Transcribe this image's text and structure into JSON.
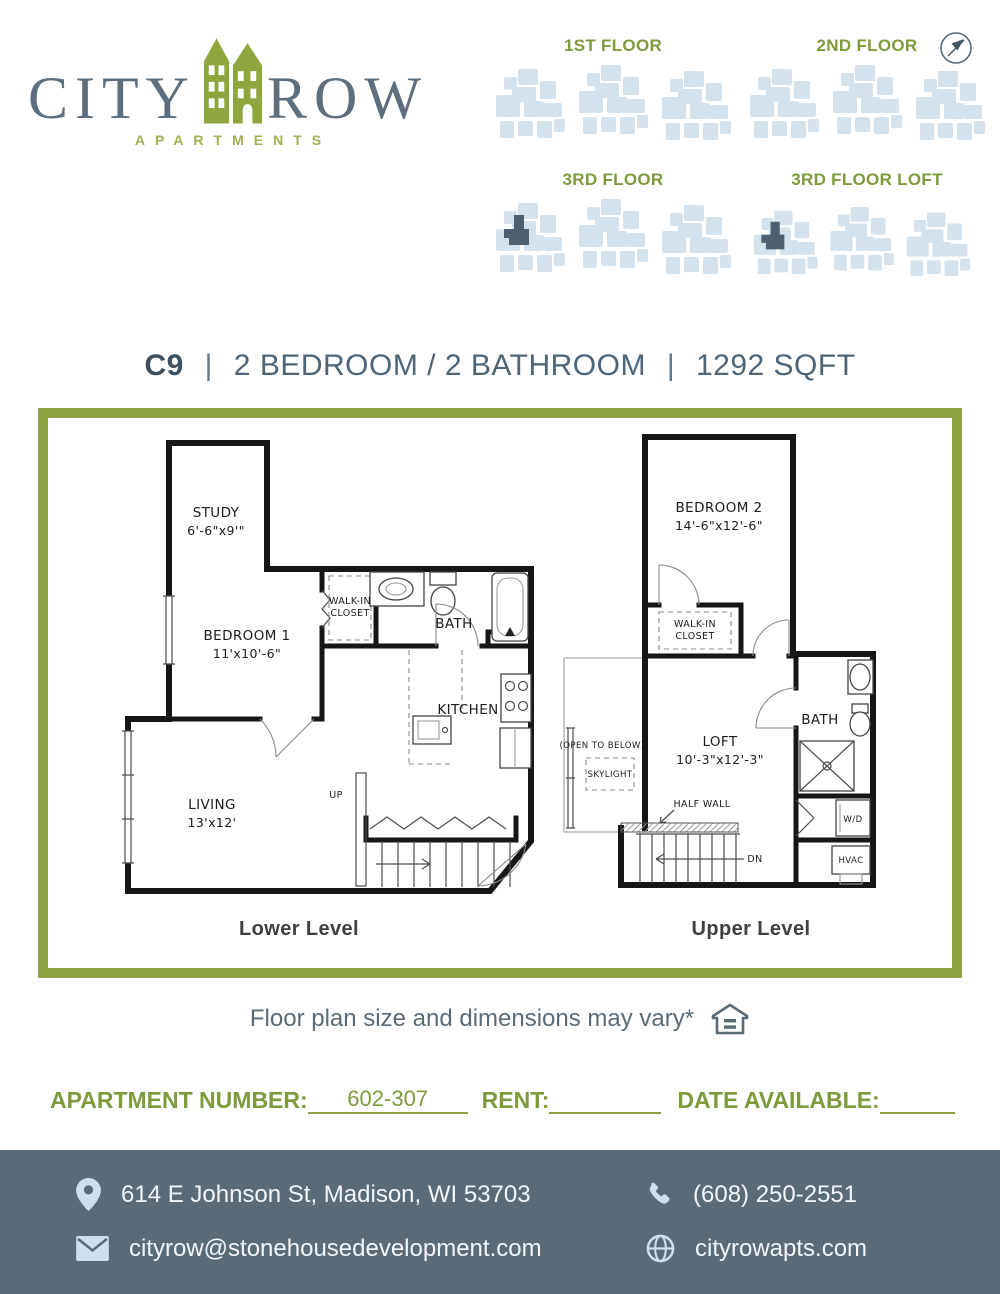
{
  "logo": {
    "city": "CITY",
    "row": "ROW",
    "subtitle": "APARTMENTS"
  },
  "floor_maps": {
    "first": {
      "label": "1ST FLOOR"
    },
    "second": {
      "label": "2ND FLOOR"
    },
    "third": {
      "label": "3RD FLOOR"
    },
    "third_loft": {
      "label": "3RD FLOOR LOFT"
    }
  },
  "title": {
    "unit": "C9",
    "divider": "|",
    "beds_baths": "2 BEDROOM / 2 BATHROOM",
    "sqft": "1292 SQFT"
  },
  "floor_plan": {
    "lower": {
      "caption": "Lower Level",
      "study": "STUDY",
      "study_dims": "6'-6\"x9'\"",
      "bedroom1": "BEDROOM 1",
      "bedroom1_dims": "11'x10'-6\"",
      "bath": "BATH",
      "kitchen": "KITCHEN",
      "living": "LIVING",
      "living_dims": "13'x12'",
      "walk_in_line1": "WALK-IN",
      "walk_in_line2": "CLOSET",
      "up": "UP"
    },
    "upper": {
      "caption": "Upper Level",
      "bedroom2": "BEDROOM 2",
      "bedroom2_dims": "14'-6\"x12'-6\"",
      "walk_in_line1": "WALK-IN",
      "walk_in_line2": "CLOSET",
      "loft": "LOFT",
      "loft_dims": "10'-3\"x12'-3\"",
      "bath": "BATH",
      "wd": "W/D",
      "hvac": "HVAC",
      "open_to_below": "(OPEN TO BELOW)",
      "skylight": "SKYLIGHT",
      "half_wall": "HALF WALL",
      "dn": "DN"
    }
  },
  "note": {
    "text": "Floor plan size and dimensions may vary*"
  },
  "details": {
    "apartment_number_label": "APARTMENT NUMBER:",
    "apartment_number_value": "602-307",
    "rent_label": "RENT:",
    "date_available_label": "DATE AVAILABLE:"
  },
  "footer": {
    "address": "614 E Johnson St, Madison, WI 53703",
    "phone": "(608) 250-2551",
    "email": "cityrow@stonehousedevelopment.com",
    "website": "cityrowapts.com"
  },
  "colors": {
    "olive_text": "#7e9b3c",
    "olive_line": "#8ca142",
    "logo_slate": "#5d6e7e",
    "title_dark": "#3c5060",
    "map_blue": "#d4e2ee",
    "unit_highlight": "#4e6070",
    "footer_bg": "#5a6a76",
    "footer_icon": "#cfe0ec"
  }
}
